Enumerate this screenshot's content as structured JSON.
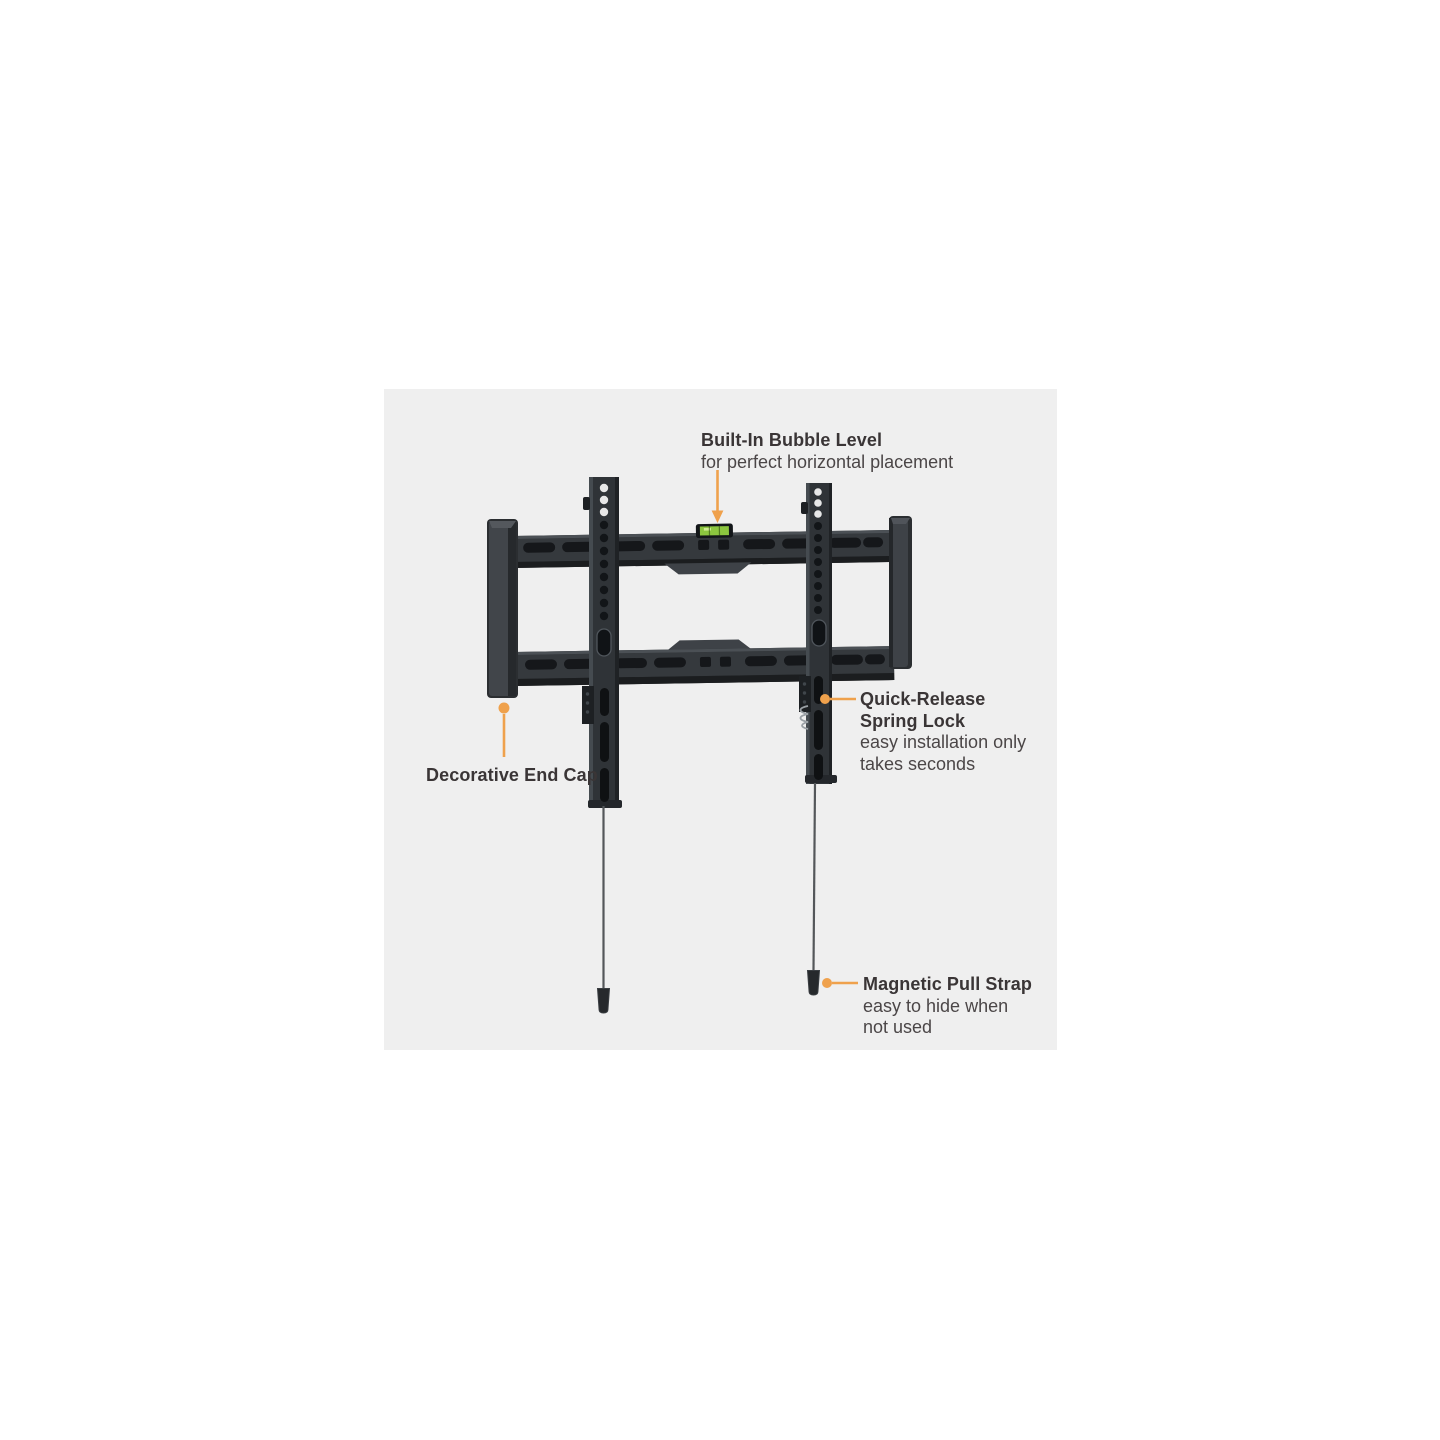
{
  "diagram": {
    "kind": "product-feature-callouts",
    "illustration": "tv-wall-mount-bracket"
  },
  "callouts": {
    "bubble_level": {
      "title": "Built-In Bubble Level",
      "description": "for perfect horizontal placement"
    },
    "spring_lock": {
      "title": "Quick-Release Spring Lock",
      "description": "easy installation only takes seconds"
    },
    "end_cap": {
      "title": "Decorative End Cap"
    },
    "pull_strap": {
      "title": "Magnetic Pull Strap",
      "description": "easy to hide when not used"
    }
  },
  "colors": {
    "accent": "#EFA14C",
    "bubble_green": "#8CC63F",
    "stage_background": "#EFEFEF",
    "mount_body": "#2F3337",
    "mount_dark": "#17191C",
    "mount_highlight": "#454B50",
    "title_text": "#3A3536",
    "description_text": "#4B4647"
  }
}
